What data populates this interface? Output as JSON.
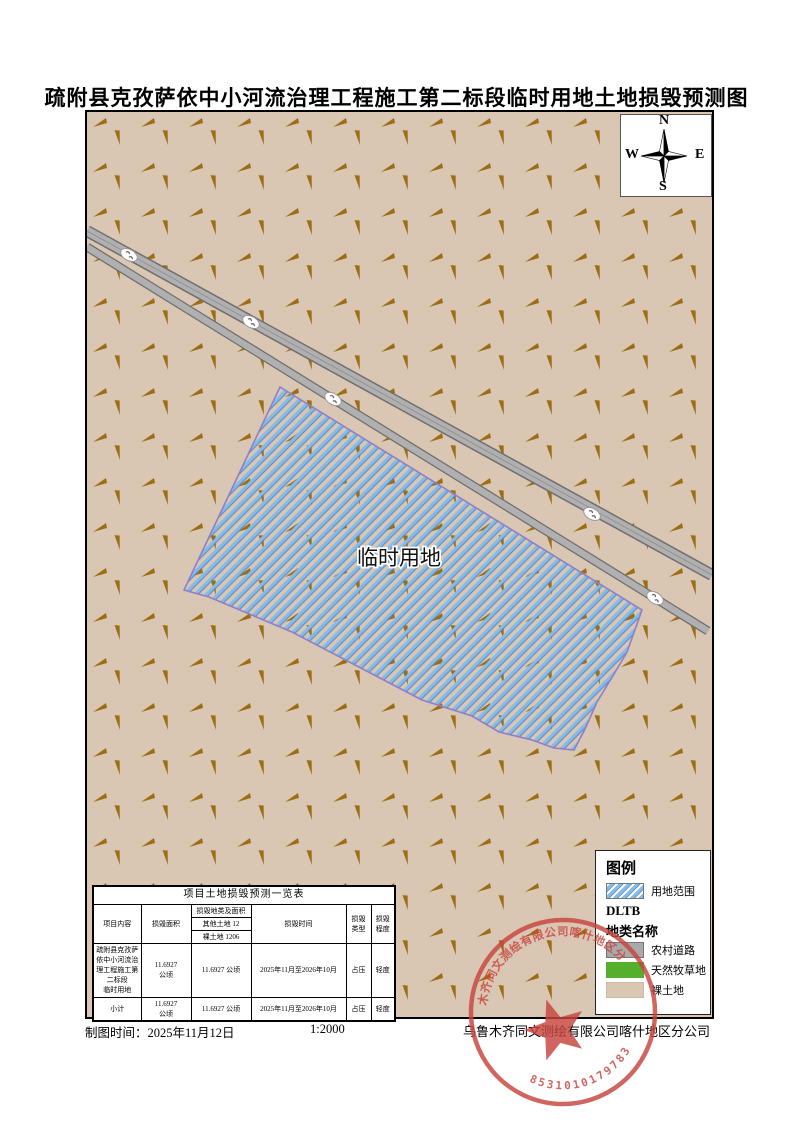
{
  "doc": {
    "title": "疏附县克孜萨依中小河流治理工程施工第二标段临时用地土地损毁预测图",
    "map_label": "临时用地"
  },
  "compass": {
    "n": "N",
    "s": "S",
    "e": "E",
    "w": "W"
  },
  "legend": {
    "title": "图例",
    "use_area_label": "用地范围",
    "dltb_label": "DLTB",
    "land_class_title": "地类名称",
    "items": [
      {
        "label": "农村道路",
        "color": "#a9a9a9"
      },
      {
        "label": "天然牧草地",
        "color": "#55ae2c"
      },
      {
        "label": "裸土地",
        "color": "#d9c6b3"
      }
    ]
  },
  "table": {
    "title": "项目土地损毁预测一览表",
    "headers": {
      "project": "项目内容",
      "area": "损毁面积",
      "land_top": "损毁地类及面积",
      "land_mid": "其他土地 12",
      "land_bot": "裸土地 1206",
      "time": "损毁时间",
      "type": "损毁\n类型",
      "degree": "损毁\n程度"
    },
    "rows": [
      {
        "project": "疏附县克孜萨\n依中小河流治\n理工程施工第\n二标段\n临时用地",
        "area": "11.6927\n公顷",
        "land_area": "11.6927 公顷",
        "time": "2025年11月至2026年10月",
        "type": "占压",
        "degree": "轻度"
      },
      {
        "project": "小计",
        "area": "11.6927\n公顷",
        "land_area": "11.6927 公顷",
        "time": "2025年11月至2026年10月",
        "type": "占压",
        "degree": "轻度"
      }
    ]
  },
  "footer": {
    "map_time": "制图时间：2025年11月12日",
    "scale": "1:2000",
    "company": "乌鲁木齐同文测绘有限公司喀什地区分公司"
  },
  "stamp": {
    "ring_text": "乌鲁木齐同文测绘有限公司喀什地区分公司",
    "number": "8531010179783"
  },
  "colors": {
    "map_background": "#d9c6b3",
    "grass_mark": "#9c6e14",
    "road_fill": "#b0b0b0",
    "road_edge": "#6f6f6f",
    "hatch_blue": "#85bbe9",
    "hatch_blue_dark": "#4e84c9",
    "parcel_outline": "#8f7fc8",
    "stamp_red": "#c8453e"
  }
}
